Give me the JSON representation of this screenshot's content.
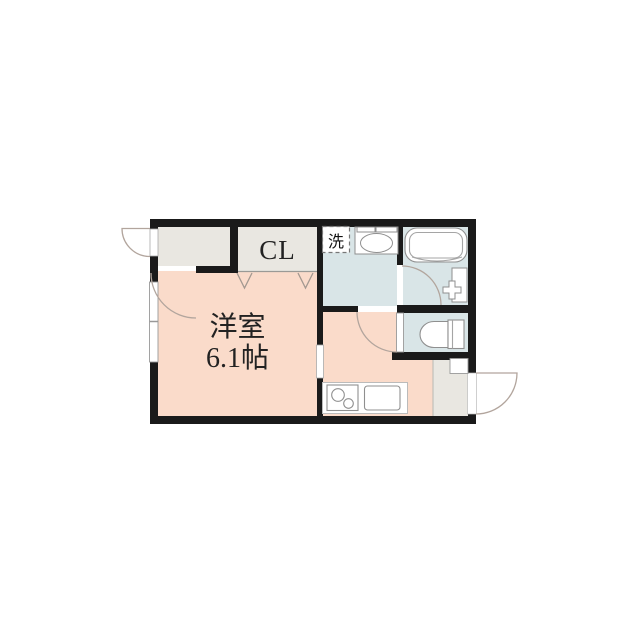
{
  "floor_plan": {
    "labels": {
      "closet": "CL",
      "laundry": "洗",
      "main_room_name": "洋室",
      "main_room_size": "6.1帖"
    },
    "rooms": [
      {
        "name": "entrance-hall"
      },
      {
        "name": "closet",
        "label": "CL"
      },
      {
        "name": "washroom"
      },
      {
        "name": "laundry-space",
        "label": "洗"
      },
      {
        "name": "bathroom"
      },
      {
        "name": "toilet-room"
      },
      {
        "name": "western-room",
        "label": "洋室",
        "size": "6.1帖"
      },
      {
        "name": "kitchen"
      },
      {
        "name": "entrance"
      }
    ],
    "fixtures": [
      "washing-machine-space-icon",
      "washbasin-icon",
      "bathtub-icon",
      "bath-faucet-icon",
      "toilet-icon",
      "stove-icon",
      "kitchen-sink-icon",
      "shoe-cabinet-icon",
      "window-icon",
      "door-swing-icons",
      "folding-door-icons"
    ],
    "colors": {
      "background": "#ffffff",
      "wall": "#1a1a1a",
      "room_pink": "#fadbca",
      "room_blue": "#d9e5e7",
      "room_gray": "#e9e7e1",
      "fixture_line": "#8f8f8f",
      "door_arc": "#b2a59d"
    }
  }
}
